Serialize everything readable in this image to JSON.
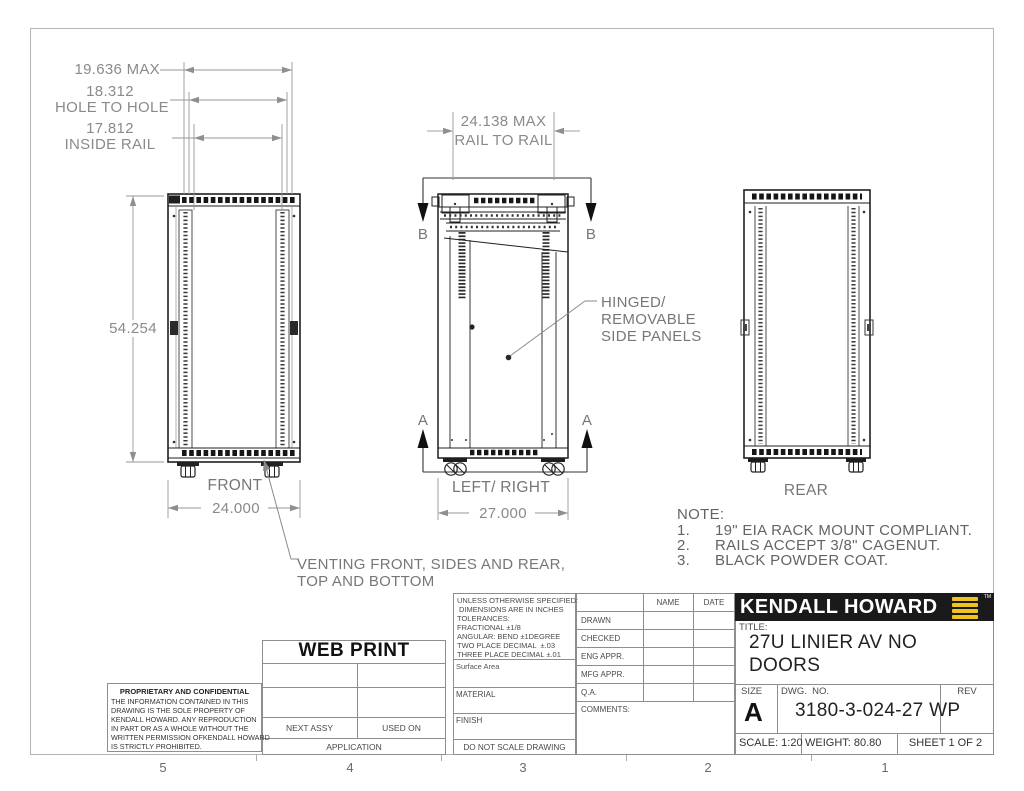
{
  "sheet": {
    "zones": [
      "5",
      "4",
      "3",
      "2",
      "1"
    ]
  },
  "dims": {
    "front_max_width": "19.636 MAX",
    "hole_to_hole_value": "18.312",
    "hole_to_hole_label": "HOLE TO HOLE",
    "inside_rail_value": "17.812",
    "inside_rail_label": "INSIDE RAIL",
    "height": "54.254",
    "front_width": "24.000",
    "rail_to_rail_value": "24.138 MAX",
    "rail_to_rail_label": "RAIL TO RAIL",
    "side_depth": "27.000"
  },
  "views": {
    "front_label": "FRONT",
    "side_label": "LEFT/ RIGHT",
    "rear_label": "REAR"
  },
  "sections": {
    "a": "A",
    "b": "B"
  },
  "callouts": {
    "hinged_line1": "HINGED/",
    "hinged_line2": "REMOVABLE",
    "hinged_line3": "SIDE PANELS",
    "venting_line1": "VENTING FRONT, SIDES AND REAR,",
    "venting_line2": "TOP AND BOTTOM"
  },
  "note": {
    "heading": "NOTE:",
    "items": [
      {
        "num": "1.",
        "text": "19\" EIA RACK MOUNT COMPLIANT."
      },
      {
        "num": "2.",
        "text": "RAILS ACCEPT 3/8\" CAGENUT."
      },
      {
        "num": "3.",
        "text": "BLACK POWDER COAT."
      }
    ]
  },
  "title_block": {
    "web_print": "WEB PRINT",
    "proprietary": {
      "heading": "PROPRIETARY AND CONFIDENTIAL",
      "lines": [
        "THE INFORMATION CONTAINED IN THIS",
        "DRAWING IS THE SOLE PROPERTY OF",
        "KENDALL HOWARD.  ANY REPRODUCTION",
        "IN PART OR AS A WHOLE WITHOUT THE",
        "WRITTEN PERMISSION OFKENDALL HOWARD",
        "IS STRICTLY PROHIBITED."
      ]
    },
    "application": {
      "next_assy": "NEXT ASSY",
      "used_on": "USED ON",
      "label": "APPLICATION"
    },
    "tolerances": {
      "lines": [
        "UNLESS OTHERWISE SPECIFIED:",
        "DIMENSIONS ARE IN INCHES",
        "TOLERANCES:",
        "FRACTIONAL ±1/8",
        "ANGULAR: BEND ±1DEGREE",
        "TWO PLACE DECIMAL  ±.03",
        "THREE PLACE DECIMAL ±.01"
      ],
      "surface_area": "Surface Area",
      "material": "MATERIAL",
      "finish": "FINISH",
      "do_not_scale": "DO NOT SCALE DRAWING"
    },
    "signoff": {
      "name_header": "NAME",
      "date_header": "DATE",
      "rows": [
        "DRAWN",
        "CHECKED",
        "ENG APPR.",
        "MFG APPR.",
        "Q.A."
      ],
      "comments": "COMMENTS:"
    },
    "brand": {
      "name": "KENDALL HOWARD",
      "tm": "TM"
    },
    "title_label": "TITLE:",
    "title_line1": "27U LINIER AV NO",
    "title_line2": "DOORS",
    "size_label": "SIZE",
    "size_value": "A",
    "dwg_label": "DWG.  NO.",
    "dwg_value": "3180-3-024-27 WP",
    "rev_label": "REV",
    "scale": "SCALE: 1:20",
    "weight": "WEIGHT: 80.80",
    "sheet": "SHEET 1 OF 2"
  },
  "colors": {
    "logo_yellow": "#EFC320",
    "bar_black": "#1a1a1a"
  }
}
